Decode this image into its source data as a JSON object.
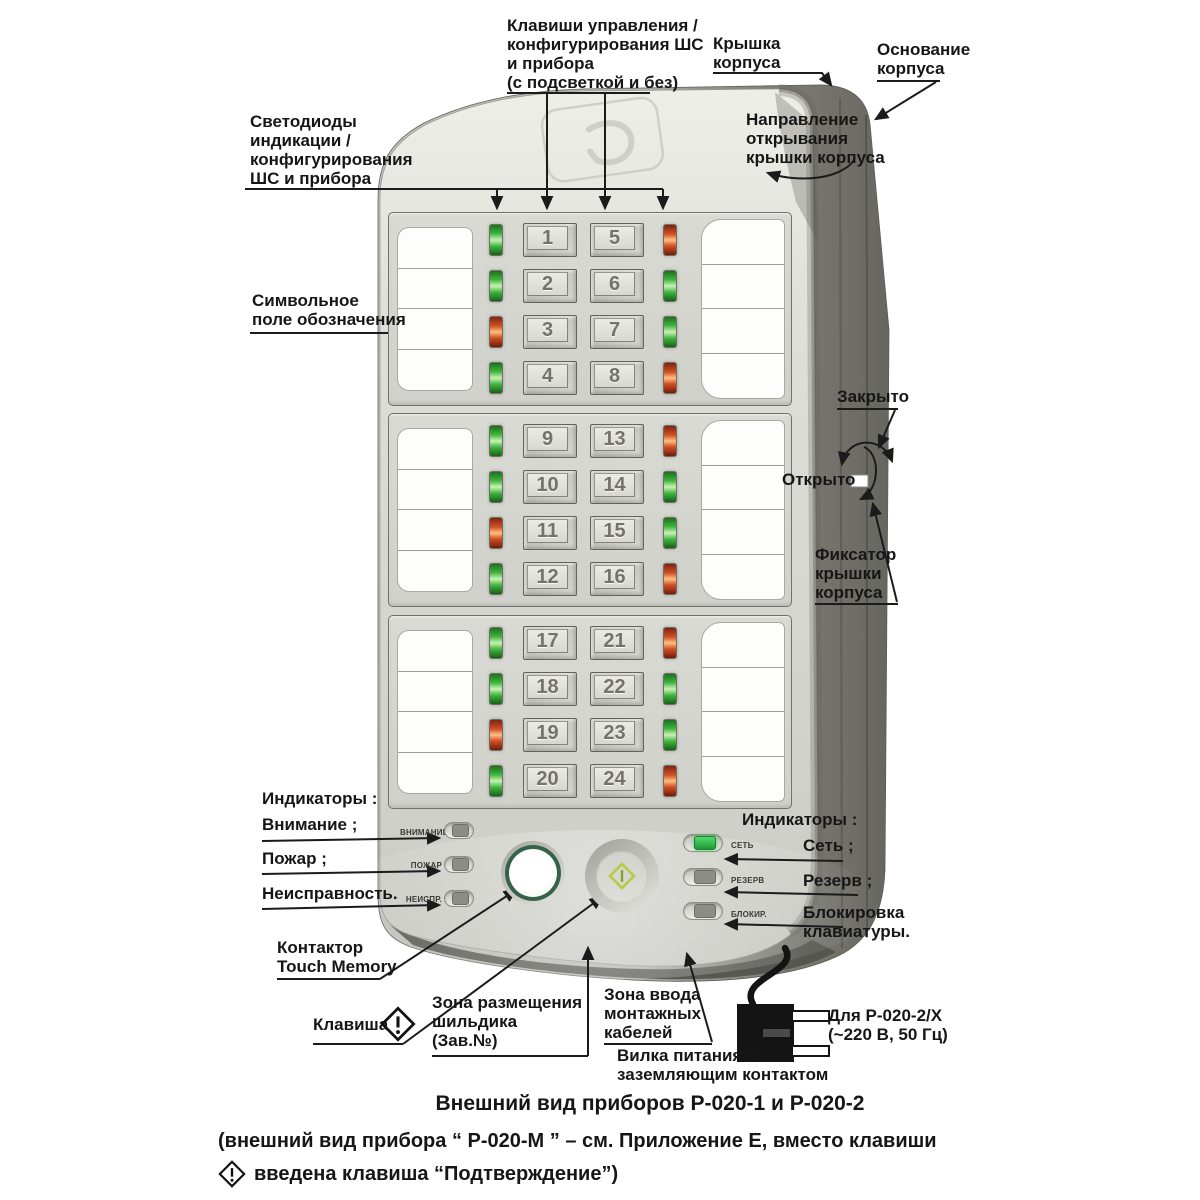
{
  "page": {
    "caption_title": "Внешний вид приборов Р-020-1 и Р-020-2",
    "caption_note_before_icon": "(внешний вид прибора “ Р-020-М ” – см. Приложение Е, вместо клавиши",
    "caption_note_after_icon": "введена клавиша “Подтверждение”)"
  },
  "annotations": {
    "keys": "Клавиши управления /\nконфигурирования ШС\nи прибора\n(с подсветкой и без)",
    "cover": "Крышка\nкорпуса",
    "base": "Основание\nкорпуса",
    "open_direction": "Направление\nоткрывания\nкрышки корпуса",
    "leds": "Светодиоды\nиндикации /\nконфигурирования\nШС и прибора",
    "symbol_field": "Символьное\nполе обозначения",
    "closed": "Закрыто",
    "opened": "Открыто",
    "latch": "Фиксатор\nкрышки\nкорпуса",
    "indicators_left_title": "Индикаторы :",
    "attention": "Внимание ;",
    "fire": "Пожар ;",
    "fault": "Неисправность.",
    "touch_memory": "Контактор\nTouch Memory",
    "key": "Клавиша",
    "nameplate": "Зона размещения\nшильдика\n(Зав.№)",
    "cable_entry": "Зона ввода\nмонтажных\nкабелей",
    "power_plug": "Вилка питания с\nзаземляющим контактом",
    "indicators_right_title": "Индикаторы :",
    "mains": "Сеть ;",
    "reserve": "Резерв ;",
    "keyboard_lock": "Блокировка\nклавиатуры.",
    "model_power": "Для Р-020-2/Х\n(~220 В, 50 Гц)"
  },
  "panel": {
    "lamps_left": [
      {
        "label": "ВНИМАНИЕ",
        "state": "off"
      },
      {
        "label": "ПОЖАР",
        "state": "off"
      },
      {
        "label": "НЕИСПР.",
        "state": "off"
      }
    ],
    "lamps_right": [
      {
        "label": "СЕТЬ",
        "state": "on"
      },
      {
        "label": "РЕЗЕРВ",
        "state": "off"
      },
      {
        "label": "БЛОКИР.",
        "state": "off"
      }
    ]
  },
  "keypad": {
    "groups": [
      {
        "rows": [
          {
            "left_led": "green",
            "keys": [
              "1",
              "5"
            ],
            "right_led": "red"
          },
          {
            "left_led": "green",
            "keys": [
              "2",
              "6"
            ],
            "right_led": "green"
          },
          {
            "left_led": "red",
            "keys": [
              "3",
              "7"
            ],
            "right_led": "green"
          },
          {
            "left_led": "green",
            "keys": [
              "4",
              "8"
            ],
            "right_led": "red"
          }
        ]
      },
      {
        "rows": [
          {
            "left_led": "green",
            "keys": [
              "9",
              "13"
            ],
            "right_led": "red"
          },
          {
            "left_led": "green",
            "keys": [
              "10",
              "14"
            ],
            "right_led": "green"
          },
          {
            "left_led": "red",
            "keys": [
              "11",
              "15"
            ],
            "right_led": "green"
          },
          {
            "left_led": "green",
            "keys": [
              "12",
              "16"
            ],
            "right_led": "red"
          }
        ]
      },
      {
        "rows": [
          {
            "left_led": "green",
            "keys": [
              "17",
              "21"
            ],
            "right_led": "red"
          },
          {
            "left_led": "green",
            "keys": [
              "18",
              "22"
            ],
            "right_led": "green"
          },
          {
            "left_led": "red",
            "keys": [
              "19",
              "23"
            ],
            "right_led": "green"
          },
          {
            "left_led": "green",
            "keys": [
              "20",
              "24"
            ],
            "right_led": "red"
          }
        ]
      }
    ]
  },
  "colors": {
    "led_green": "#3cb23c",
    "led_red": "#cf4f24",
    "lamp_on_green": "#1d9a38",
    "key_icon_green": "#b7cc40"
  }
}
